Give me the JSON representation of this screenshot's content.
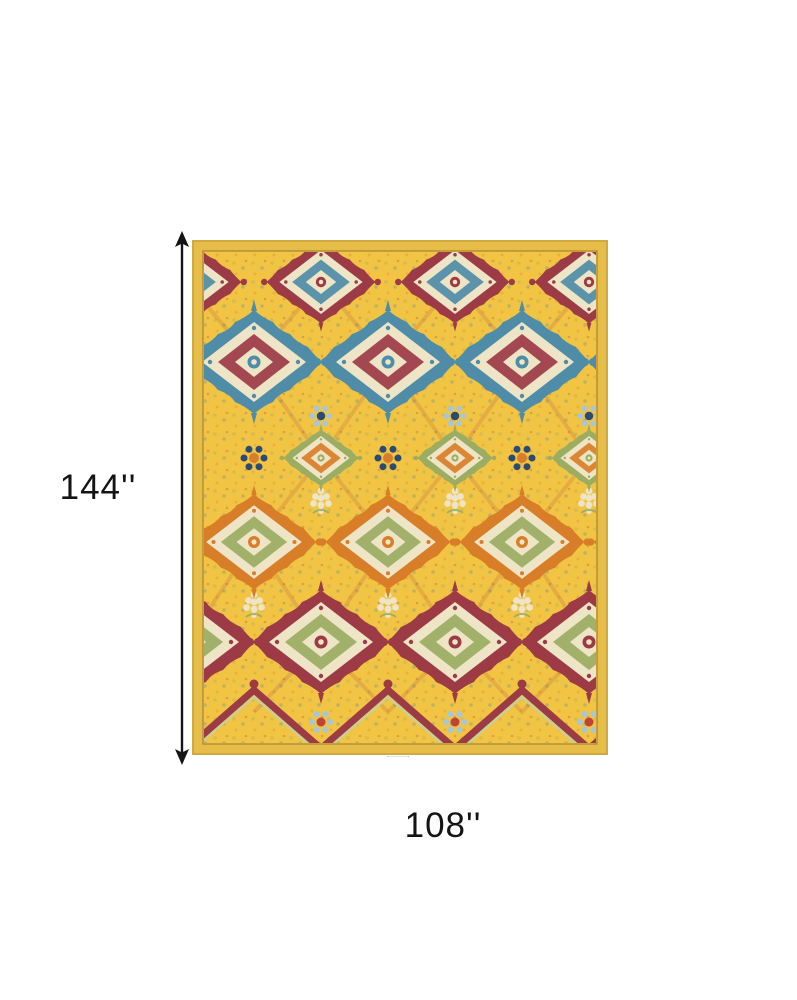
{
  "diagram": {
    "height_label": "144''",
    "width_label": "108''",
    "arrow_color": "#141414",
    "text_color": "#141414"
  },
  "rug": {
    "alt": "ornate yellow multicolor medallion area rug",
    "colors": {
      "border": "#e6bd48",
      "edge": "#c8a43c",
      "field": "#f2c443",
      "fieldline": "#8a6b2d",
      "maroon": "#9c3a46",
      "red": "#bf4436",
      "teal": "#4e8ca8",
      "navy": "#2c4b72",
      "orange": "#d97e28",
      "green": "#9aad62",
      "lightgreen": "#c7d095",
      "cream": "#eee4c6",
      "lightblue": "#a7c6d6"
    }
  }
}
